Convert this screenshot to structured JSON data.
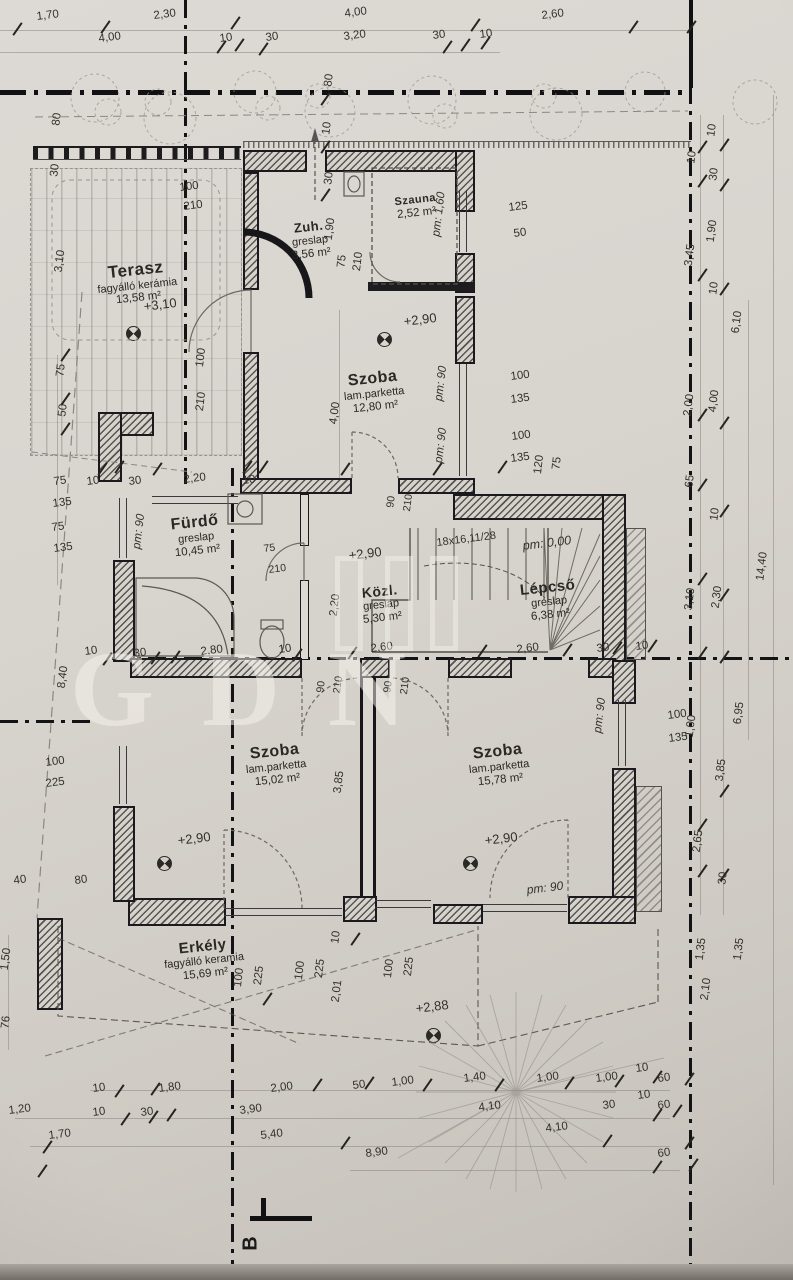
{
  "drawing": {
    "kind": "architectural floor plan (emelet / upper floor)",
    "language": "Hungarian",
    "ink_color": "#2b2925",
    "paper_color": "#d6d2cc"
  },
  "watermark": {
    "text": "GDN"
  },
  "section_marker": {
    "label": "B"
  },
  "rooms": [
    {
      "name": "Terasz",
      "finish": "fagyálló kerámia",
      "area": "13,58 m²",
      "x": 137,
      "y": 260,
      "s": 17
    },
    {
      "name": "Zuh.",
      "finish": "greslap",
      "area": "3,56 m²",
      "x": 310,
      "y": 220,
      "s": 13
    },
    {
      "name": "Szauna",
      "finish": "",
      "area": "2,52 m²",
      "x": 416,
      "y": 194,
      "s": 11
    },
    {
      "name": "Szoba",
      "finish": "lam.parketta",
      "area": "12,80 m²",
      "x": 374,
      "y": 370,
      "s": 16
    },
    {
      "name": "Fürdő",
      "finish": "greslap",
      "area": "10,45 m²",
      "x": 196,
      "y": 514,
      "s": 16
    },
    {
      "name": "Közl.",
      "finish": "greslap",
      "area": "5,30 m²",
      "x": 381,
      "y": 583,
      "s": 14
    },
    {
      "name": "Lépcső",
      "finish": "greslap",
      "area": "6,38 m²",
      "x": 549,
      "y": 579,
      "s": 15
    },
    {
      "name": "Szoba",
      "finish": "lam.parketta",
      "area": "15,02 m²",
      "x": 276,
      "y": 743,
      "s": 16
    },
    {
      "name": "Szoba",
      "finish": "lam.parketta",
      "area": "15,78 m²",
      "x": 499,
      "y": 743,
      "s": 16
    },
    {
      "name": "Erkély",
      "finish": "fagyálló keramia",
      "area": "15,69 m²",
      "x": 204,
      "y": 938,
      "s": 15
    }
  ],
  "plan": {
    "labels": [
      {
        "t": "1,70",
        "x": 36,
        "y": 12
      },
      {
        "t": "2,30",
        "x": 153,
        "y": 11
      },
      {
        "t": "4,00",
        "x": 344,
        "y": 9
      },
      {
        "t": "2,60",
        "x": 541,
        "y": 11
      },
      {
        "t": "4,00",
        "x": 98,
        "y": 34
      },
      {
        "t": "10",
        "x": 219,
        "y": 34
      },
      {
        "t": "30",
        "x": 265,
        "y": 33
      },
      {
        "t": "3,20",
        "x": 343,
        "y": 32
      },
      {
        "t": "30",
        "x": 432,
        "y": 31
      },
      {
        "t": "10",
        "x": 479,
        "y": 30
      },
      {
        "t": "80",
        "x": 52,
        "y": 113,
        "v": 1
      },
      {
        "t": "30",
        "x": 50,
        "y": 164,
        "v": 1
      },
      {
        "t": "3,10",
        "x": 55,
        "y": 250,
        "v": 1
      },
      {
        "t": "75",
        "x": 56,
        "y": 364,
        "v": 1
      },
      {
        "t": "50",
        "x": 58,
        "y": 404,
        "v": 1
      },
      {
        "t": "80",
        "x": 324,
        "y": 74,
        "v": 1
      },
      {
        "t": "10",
        "x": 322,
        "y": 122,
        "v": 1
      },
      {
        "t": "30",
        "x": 324,
        "y": 172,
        "v": 1
      },
      {
        "t": "100",
        "x": 179,
        "y": 183
      },
      {
        "t": "210",
        "x": 183,
        "y": 202
      },
      {
        "t": "100",
        "x": 196,
        "y": 348,
        "v": 1
      },
      {
        "t": "210",
        "x": 196,
        "y": 392,
        "v": 1
      },
      {
        "t": "+3,10",
        "x": 143,
        "y": 300,
        "s": 13
      },
      {
        "t": "1,90",
        "x": 325,
        "y": 218,
        "v": 1
      },
      {
        "t": "75",
        "x": 337,
        "y": 255,
        "v": 1
      },
      {
        "t": "210",
        "x": 353,
        "y": 252,
        "v": 1
      },
      {
        "t": "pm: 1,60",
        "x": 434,
        "y": 192,
        "v": 1,
        "i": 1
      },
      {
        "t": "125",
        "x": 508,
        "y": 203
      },
      {
        "t": "50",
        "x": 513,
        "y": 229
      },
      {
        "t": "+2,90",
        "x": 403,
        "y": 315,
        "s": 13
      },
      {
        "t": "4,00",
        "x": 330,
        "y": 402,
        "v": 1
      },
      {
        "t": "pm: 90",
        "x": 436,
        "y": 366,
        "v": 1,
        "i": 1
      },
      {
        "t": "pm: 90",
        "x": 436,
        "y": 428,
        "v": 1,
        "i": 1
      },
      {
        "t": "100",
        "x": 510,
        "y": 372
      },
      {
        "t": "135",
        "x": 510,
        "y": 395
      },
      {
        "t": "100",
        "x": 511,
        "y": 432
      },
      {
        "t": "135",
        "x": 510,
        "y": 454
      },
      {
        "t": "120",
        "x": 534,
        "y": 455,
        "v": 1
      },
      {
        "t": "75",
        "x": 552,
        "y": 457,
        "v": 1
      },
      {
        "t": "75",
        "x": 53,
        "y": 477
      },
      {
        "t": "135",
        "x": 52,
        "y": 499
      },
      {
        "t": "75",
        "x": 51,
        "y": 523
      },
      {
        "t": "135",
        "x": 53,
        "y": 544
      },
      {
        "t": "10",
        "x": 86,
        "y": 477
      },
      {
        "t": "30",
        "x": 128,
        "y": 477
      },
      {
        "t": "2,20",
        "x": 183,
        "y": 475
      },
      {
        "t": "10",
        "x": 242,
        "y": 476
      },
      {
        "t": "pm: 90",
        "x": 134,
        "y": 514,
        "v": 1,
        "i": 1
      },
      {
        "t": "90",
        "x": 386,
        "y": 496,
        "v": 1,
        "s": 10.5
      },
      {
        "t": "210",
        "x": 403,
        "y": 494,
        "v": 1,
        "s": 10.5
      },
      {
        "t": "75",
        "x": 263,
        "y": 544,
        "s": 10.5
      },
      {
        "t": "210",
        "x": 268,
        "y": 565,
        "s": 10.5
      },
      {
        "t": "18x16,11/28",
        "x": 436,
        "y": 538,
        "s": 11
      },
      {
        "t": "pm: 0,00",
        "x": 522,
        "y": 540,
        "i": 1,
        "s": 12.5
      },
      {
        "t": "+2,90",
        "x": 348,
        "y": 549,
        "s": 13
      },
      {
        "t": "2,20",
        "x": 330,
        "y": 594,
        "v": 1
      },
      {
        "t": "8,40",
        "x": 58,
        "y": 666,
        "v": 1
      },
      {
        "t": "10",
        "x": 84,
        "y": 647
      },
      {
        "t": "30",
        "x": 133,
        "y": 649
      },
      {
        "t": "2,80",
        "x": 200,
        "y": 647
      },
      {
        "t": "10",
        "x": 278,
        "y": 645
      },
      {
        "t": "2,60",
        "x": 370,
        "y": 644
      },
      {
        "t": "2,60",
        "x": 516,
        "y": 645
      },
      {
        "t": "30",
        "x": 596,
        "y": 644
      },
      {
        "t": "10",
        "x": 635,
        "y": 642
      },
      {
        "t": "90",
        "x": 316,
        "y": 681,
        "v": 1,
        "s": 10.5
      },
      {
        "t": "210",
        "x": 333,
        "y": 676,
        "v": 1,
        "s": 10.5
      },
      {
        "t": "90",
        "x": 383,
        "y": 681,
        "v": 1,
        "s": 10.5
      },
      {
        "t": "210",
        "x": 400,
        "y": 677,
        "v": 1,
        "s": 10.5
      },
      {
        "t": "3,85",
        "x": 334,
        "y": 771,
        "v": 1
      },
      {
        "t": "pm: 90",
        "x": 595,
        "y": 698,
        "v": 1,
        "i": 1
      },
      {
        "t": "+2,90",
        "x": 177,
        "y": 834,
        "s": 13
      },
      {
        "t": "+2,90",
        "x": 484,
        "y": 834,
        "s": 13
      },
      {
        "t": "pm: 90",
        "x": 526,
        "y": 884,
        "i": 1,
        "s": 12
      },
      {
        "t": "100",
        "x": 45,
        "y": 758
      },
      {
        "t": "225",
        "x": 45,
        "y": 779
      },
      {
        "t": "40",
        "x": 13,
        "y": 876
      },
      {
        "t": "80",
        "x": 74,
        "y": 876
      },
      {
        "t": "1,50",
        "x": 1,
        "y": 948,
        "v": 1
      },
      {
        "t": "76",
        "x": 1,
        "y": 1016,
        "v": 1
      },
      {
        "t": "100",
        "x": 234,
        "y": 968,
        "v": 1
      },
      {
        "t": "225",
        "x": 254,
        "y": 966,
        "v": 1
      },
      {
        "t": "100",
        "x": 295,
        "y": 961,
        "v": 1
      },
      {
        "t": "225",
        "x": 315,
        "y": 959,
        "v": 1
      },
      {
        "t": "2,01",
        "x": 332,
        "y": 980,
        "v": 1
      },
      {
        "t": "100",
        "x": 384,
        "y": 959,
        "v": 1
      },
      {
        "t": "225",
        "x": 404,
        "y": 957,
        "v": 1
      },
      {
        "t": "10",
        "x": 331,
        "y": 931,
        "v": 1
      },
      {
        "t": "+2,88",
        "x": 415,
        "y": 1002,
        "s": 13
      },
      {
        "t": "10",
        "x": 707,
        "y": 124,
        "v": 1
      },
      {
        "t": "10",
        "x": 687,
        "y": 151,
        "v": 1
      },
      {
        "t": "30",
        "x": 709,
        "y": 168,
        "v": 1
      },
      {
        "t": "1,90",
        "x": 707,
        "y": 220,
        "v": 1
      },
      {
        "t": "3,45",
        "x": 685,
        "y": 244,
        "v": 1
      },
      {
        "t": "10",
        "x": 709,
        "y": 282,
        "v": 1
      },
      {
        "t": "6,10",
        "x": 732,
        "y": 311,
        "v": 1
      },
      {
        "t": "2,00",
        "x": 684,
        "y": 394,
        "v": 1
      },
      {
        "t": "4,00",
        "x": 709,
        "y": 390,
        "v": 1
      },
      {
        "t": "65",
        "x": 685,
        "y": 475,
        "v": 1
      },
      {
        "t": "10",
        "x": 710,
        "y": 508,
        "v": 1
      },
      {
        "t": "3,10",
        "x": 685,
        "y": 588,
        "v": 1
      },
      {
        "t": "2,30",
        "x": 712,
        "y": 586,
        "v": 1
      },
      {
        "t": "14,40",
        "x": 757,
        "y": 552,
        "v": 1
      },
      {
        "t": "6,95",
        "x": 734,
        "y": 702,
        "v": 1
      },
      {
        "t": "100",
        "x": 667,
        "y": 711
      },
      {
        "t": "135",
        "x": 668,
        "y": 734
      },
      {
        "t": "1,00",
        "x": 686,
        "y": 715,
        "v": 1
      },
      {
        "t": "3,85",
        "x": 716,
        "y": 759,
        "v": 1
      },
      {
        "t": "2,65",
        "x": 693,
        "y": 830,
        "v": 1
      },
      {
        "t": "30",
        "x": 718,
        "y": 872,
        "v": 1
      },
      {
        "t": "1,35",
        "x": 696,
        "y": 938,
        "v": 1
      },
      {
        "t": "1,35",
        "x": 734,
        "y": 938,
        "v": 1
      },
      {
        "t": "2,10",
        "x": 701,
        "y": 978,
        "v": 1
      },
      {
        "t": "10",
        "x": 92,
        "y": 1084
      },
      {
        "t": "1,80",
        "x": 158,
        "y": 1084
      },
      {
        "t": "2,00",
        "x": 270,
        "y": 1084
      },
      {
        "t": "50",
        "x": 352,
        "y": 1081
      },
      {
        "t": "1,00",
        "x": 391,
        "y": 1078
      },
      {
        "t": "1,40",
        "x": 463,
        "y": 1074
      },
      {
        "t": "1,00",
        "x": 536,
        "y": 1074
      },
      {
        "t": "1,00",
        "x": 595,
        "y": 1074
      },
      {
        "t": "10",
        "x": 635,
        "y": 1064
      },
      {
        "t": "60",
        "x": 657,
        "y": 1074
      },
      {
        "t": "1,20",
        "x": 8,
        "y": 1106
      },
      {
        "t": "10",
        "x": 92,
        "y": 1108
      },
      {
        "t": "30",
        "x": 140,
        "y": 1108
      },
      {
        "t": "3,90",
        "x": 239,
        "y": 1106
      },
      {
        "t": "4,10",
        "x": 478,
        "y": 1103
      },
      {
        "t": "30",
        "x": 602,
        "y": 1101
      },
      {
        "t": "10",
        "x": 637,
        "y": 1091
      },
      {
        "t": "60",
        "x": 657,
        "y": 1101
      },
      {
        "t": "1,70",
        "x": 48,
        "y": 1131
      },
      {
        "t": "5,40",
        "x": 260,
        "y": 1131
      },
      {
        "t": "4,10",
        "x": 545,
        "y": 1124
      },
      {
        "t": "8,90",
        "x": 365,
        "y": 1149
      },
      {
        "t": "60",
        "x": 657,
        "y": 1149
      }
    ],
    "ticks": [
      [
        10,
        28
      ],
      [
        98,
        26
      ],
      [
        228,
        22
      ],
      [
        468,
        24
      ],
      [
        626,
        26
      ],
      [
        684,
        26
      ],
      [
        214,
        46
      ],
      [
        232,
        44
      ],
      [
        256,
        48
      ],
      [
        440,
        46
      ],
      [
        458,
        44
      ],
      [
        478,
        42
      ],
      [
        318,
        98
      ],
      [
        318,
        146
      ],
      [
        318,
        194
      ],
      [
        58,
        354
      ],
      [
        58,
        398
      ],
      [
        58,
        428
      ],
      [
        95,
        468
      ],
      [
        112,
        466
      ],
      [
        150,
        468
      ],
      [
        240,
        466
      ],
      [
        256,
        466
      ],
      [
        338,
        468
      ],
      [
        430,
        468
      ],
      [
        495,
        466
      ],
      [
        100,
        658
      ],
      [
        148,
        657
      ],
      [
        168,
        656
      ],
      [
        290,
        654
      ],
      [
        345,
        652
      ],
      [
        475,
        650
      ],
      [
        560,
        649
      ],
      [
        610,
        647
      ],
      [
        645,
        645
      ],
      [
        112,
        1090
      ],
      [
        148,
        1088
      ],
      [
        310,
        1084
      ],
      [
        362,
        1082
      ],
      [
        420,
        1084
      ],
      [
        492,
        1084
      ],
      [
        562,
        1082
      ],
      [
        612,
        1080
      ],
      [
        650,
        1076
      ],
      [
        682,
        1078
      ],
      [
        118,
        1118
      ],
      [
        146,
        1116
      ],
      [
        164,
        1114
      ],
      [
        650,
        1114
      ],
      [
        670,
        1110
      ],
      [
        40,
        1146
      ],
      [
        338,
        1142
      ],
      [
        600,
        1140
      ],
      [
        682,
        1142
      ],
      [
        35,
        1170
      ],
      [
        650,
        1166
      ],
      [
        686,
        1164
      ],
      [
        695,
        146
      ],
      [
        717,
        144
      ],
      [
        695,
        180
      ],
      [
        717,
        184
      ],
      [
        695,
        274
      ],
      [
        717,
        288
      ],
      [
        695,
        414
      ],
      [
        717,
        422
      ],
      [
        695,
        484
      ],
      [
        717,
        510
      ],
      [
        695,
        578
      ],
      [
        717,
        594
      ],
      [
        695,
        652
      ],
      [
        717,
        656
      ],
      [
        695,
        824
      ],
      [
        717,
        790
      ],
      [
        695,
        870
      ],
      [
        717,
        874
      ],
      [
        348,
        938
      ],
      [
        260,
        998
      ]
    ]
  }
}
